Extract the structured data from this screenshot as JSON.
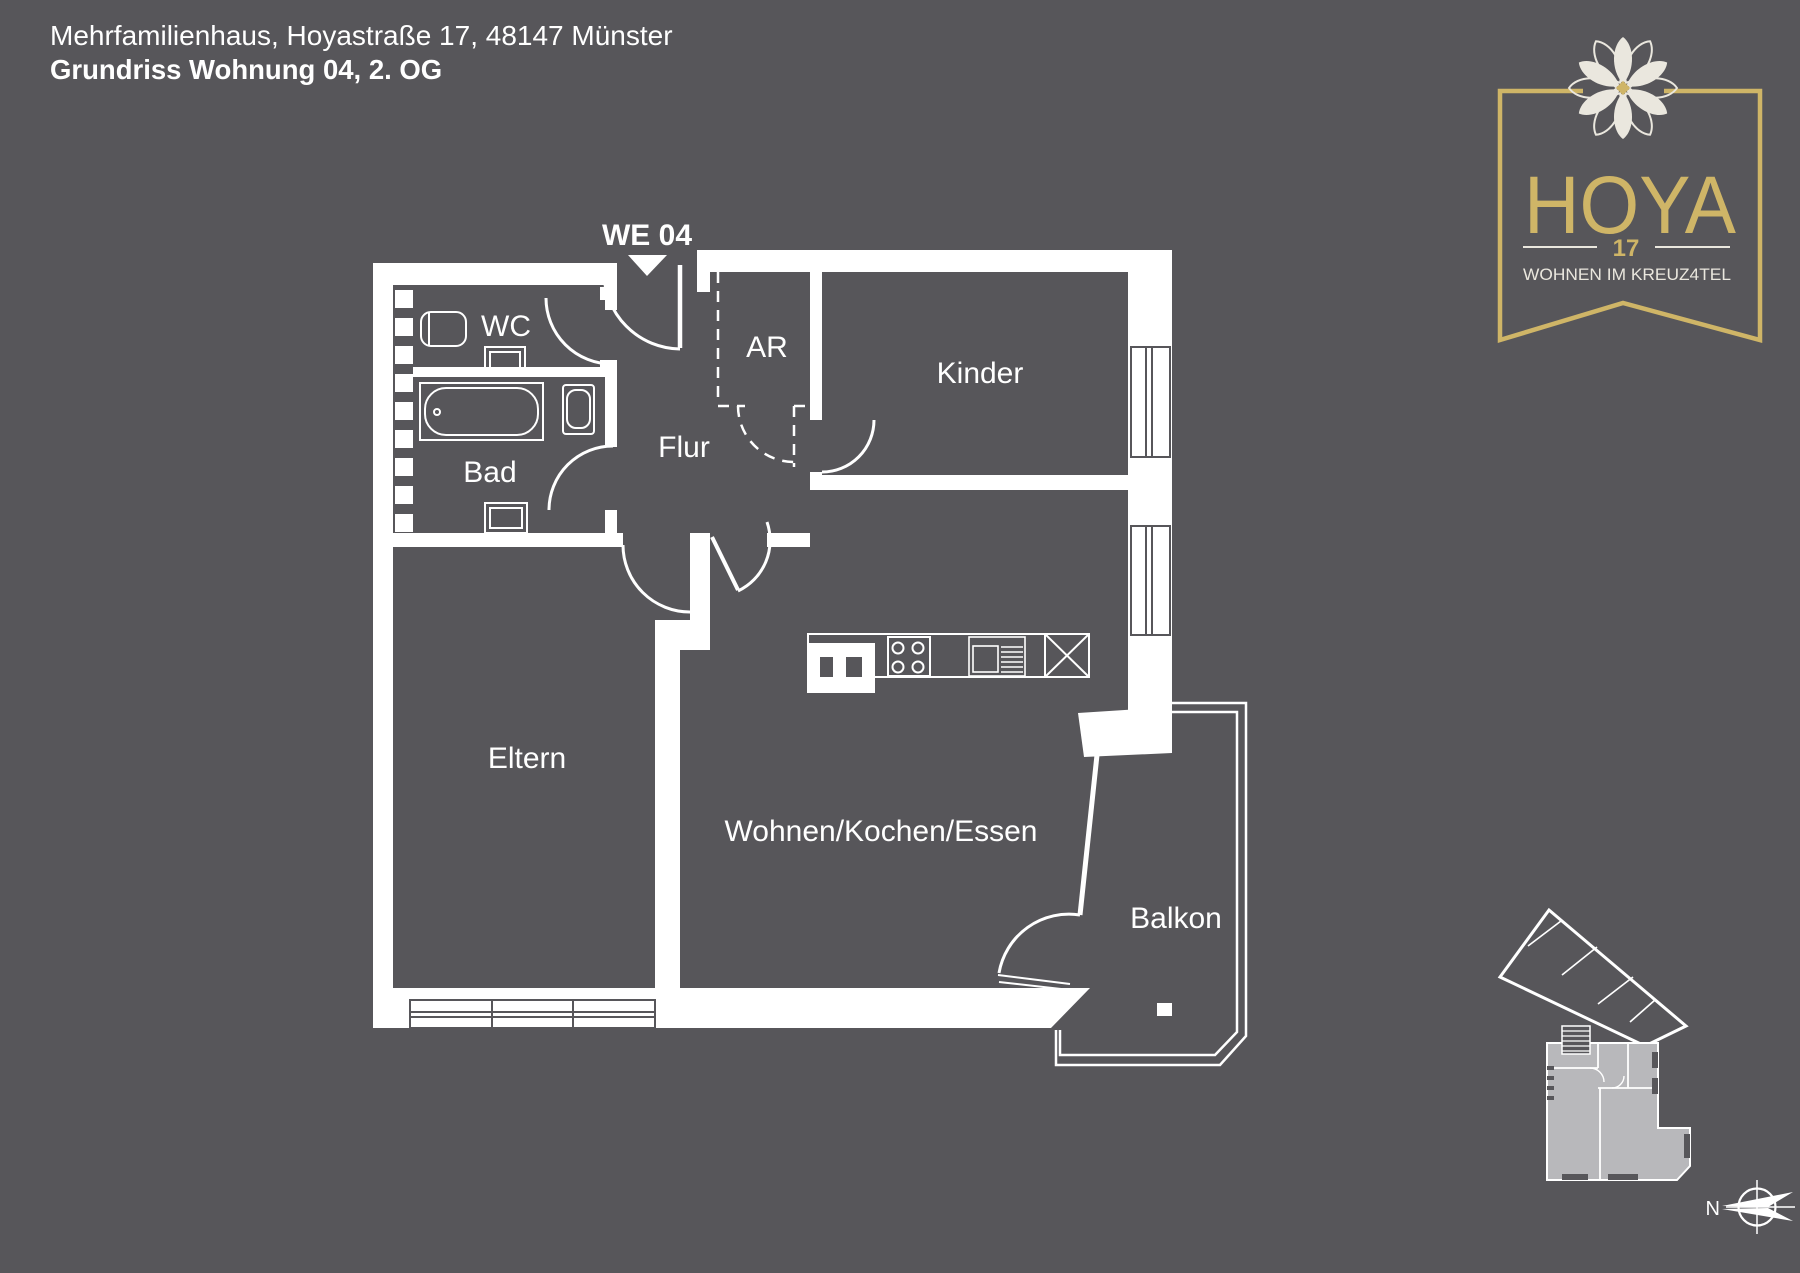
{
  "header": {
    "address_line": "Mehrfamilienhaus, Hoyastraße 17, 48147 Münster",
    "title_line": "Grundriss Wohnung 04, 2. OG"
  },
  "plan": {
    "unit_marker": "WE 04",
    "rooms": {
      "wc": "WC",
      "bad": "Bad",
      "flur": "Flur",
      "ar": "AR",
      "kinder": "Kinder",
      "eltern": "Eltern",
      "wohnen": "Wohnen/Kochen/Essen",
      "balkon": "Balkon"
    }
  },
  "logo": {
    "name": "HOYA",
    "number": "17",
    "tagline": "WOHNEN IM KREUZ4TEL"
  },
  "compass": {
    "north_label": "N"
  },
  "colors": {
    "background": "#57565a",
    "line_white": "#ffffff",
    "logo_gold": "#cfb567",
    "logo_cream": "#eae7de",
    "keyplan_fill": "#b8b8bb"
  }
}
